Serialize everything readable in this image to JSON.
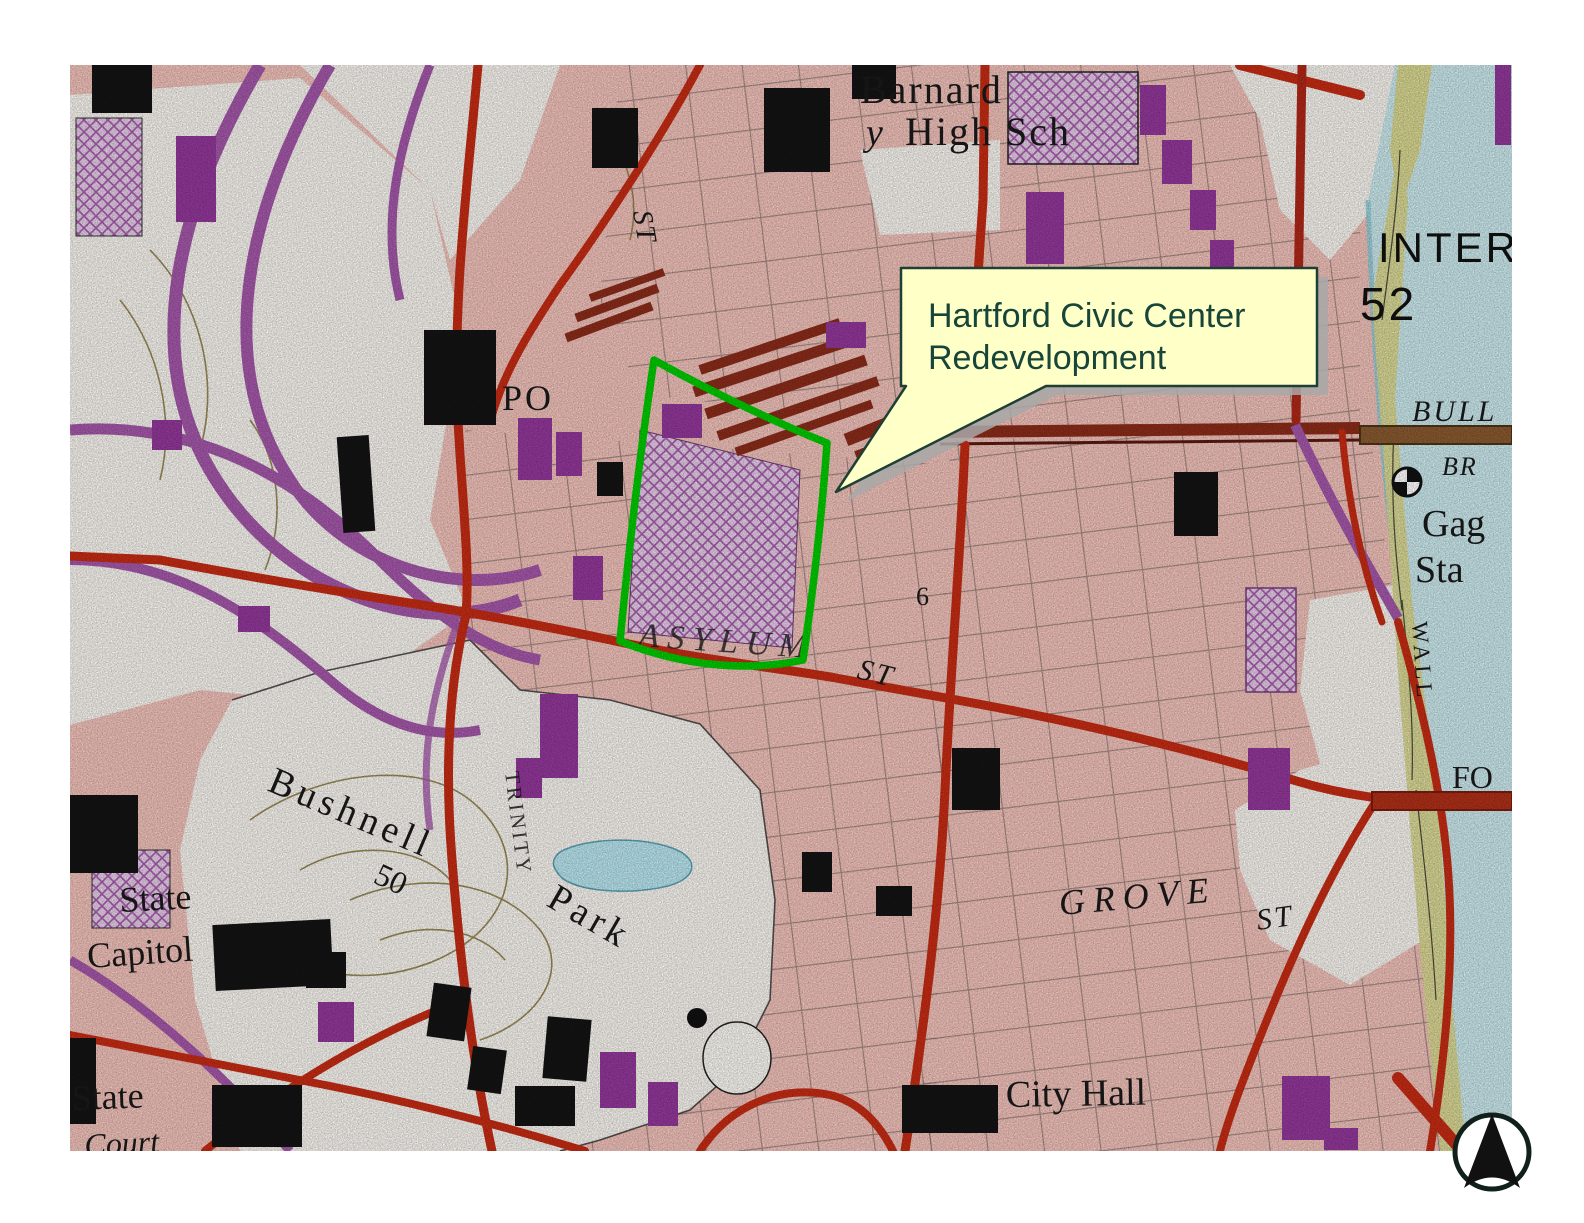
{
  "map": {
    "description": "USGS-style topographic map of downtown Hartford with highlighted redevelopment parcel",
    "callout": {
      "line1": "Hartford Civic Center",
      "line2": "Redevelopment"
    },
    "labels": {
      "school_line1": "Barnard",
      "school_line2": "High Sch",
      "school_fragment": "y",
      "inter": "INTER",
      "inter_number": "52",
      "bull": "BULL",
      "br": "BR",
      "gag": "Gag",
      "sta": "Sta",
      "po": "PO",
      "st_north": "ST",
      "asylum": "ASYLUM",
      "asylum_st": "ST",
      "spot6": "6",
      "bushnell": "Bushnell",
      "contour50": "50",
      "park": "Park",
      "trinity": "TRINITY",
      "capitol1": "State",
      "capitol2": "Capitol",
      "state2": "State",
      "court": "Court",
      "grove": "GROVE",
      "grove_st": "ST",
      "cityhall": "City Hall",
      "fo": "FO",
      "wall": "WALL"
    },
    "colors": {
      "highlight_green": "#00cc00",
      "callout_bg": "#ffffc8",
      "callout_border": "#1e3f33",
      "callout_text": "#17453a",
      "urban_pink": "#f1c2ba",
      "river_blue": "#cbe9ed",
      "road_red": "#c62c14",
      "railroad_maroon": "#8c2c1a",
      "highway_purple": "#a558aa",
      "bank_olive": "#d9d892"
    }
  }
}
